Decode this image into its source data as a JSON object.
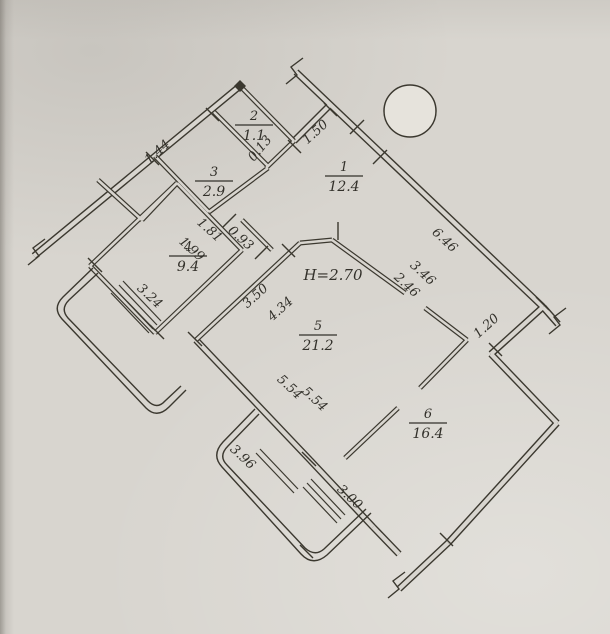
{
  "drawing": {
    "kind_note": "hand-drawn apartment floor plan, rotated diagonally",
    "palette": {
      "paper": "#d8d5cf",
      "ink": "#3b382f",
      "label_ink": "#32302a",
      "column_fill": "#e6e3dc"
    },
    "height_note": {
      "text": "Н=2.70",
      "x": 333,
      "y": 280
    },
    "rooms": [
      {
        "number": "1",
        "area": "12.4",
        "x": 344,
        "y": 176
      },
      {
        "number": "2",
        "area": "1.1",
        "x": 254,
        "y": 125
      },
      {
        "number": "3",
        "area": "2.9",
        "x": 214,
        "y": 181
      },
      {
        "number": "4",
        "area": "9.4",
        "x": 188,
        "y": 256
      },
      {
        "number": "5",
        "area": "21.2",
        "x": 318,
        "y": 335
      },
      {
        "number": "6",
        "area": "16.4",
        "x": 428,
        "y": 423
      }
    ],
    "dimensions": [
      {
        "text": "1.44",
        "x": 160,
        "y": 155,
        "r": -42
      },
      {
        "text": "0.13",
        "x": 263,
        "y": 151,
        "r": -50
      },
      {
        "text": "1.50",
        "x": 318,
        "y": 135,
        "r": -42
      },
      {
        "text": "1.81",
        "x": 207,
        "y": 233,
        "r": 42
      },
      {
        "text": "1.99",
        "x": 189,
        "y": 252,
        "r": 42
      },
      {
        "text": "0.93",
        "x": 238,
        "y": 241,
        "r": 42
      },
      {
        "text": "6.46",
        "x": 442,
        "y": 243,
        "r": 43
      },
      {
        "text": "3.46",
        "x": 420,
        "y": 276,
        "r": 43
      },
      {
        "text": "2.46",
        "x": 404,
        "y": 288,
        "r": 43
      },
      {
        "text": "1.20",
        "x": 489,
        "y": 329,
        "r": -42
      },
      {
        "text": "3.50",
        "x": 258,
        "y": 299,
        "r": -42
      },
      {
        "text": "4.34",
        "x": 283,
        "y": 312,
        "r": -42
      },
      {
        "text": "5.54",
        "x": 287,
        "y": 390,
        "r": 43
      },
      {
        "text": "5.54",
        "x": 312,
        "y": 402,
        "r": 43
      },
      {
        "text": "3.24",
        "x": 147,
        "y": 299,
        "r": 43
      },
      {
        "text": "3.96",
        "x": 240,
        "y": 460,
        "r": 43
      },
      {
        "text": "3.00",
        "x": 347,
        "y": 500,
        "r": 43
      }
    ]
  }
}
